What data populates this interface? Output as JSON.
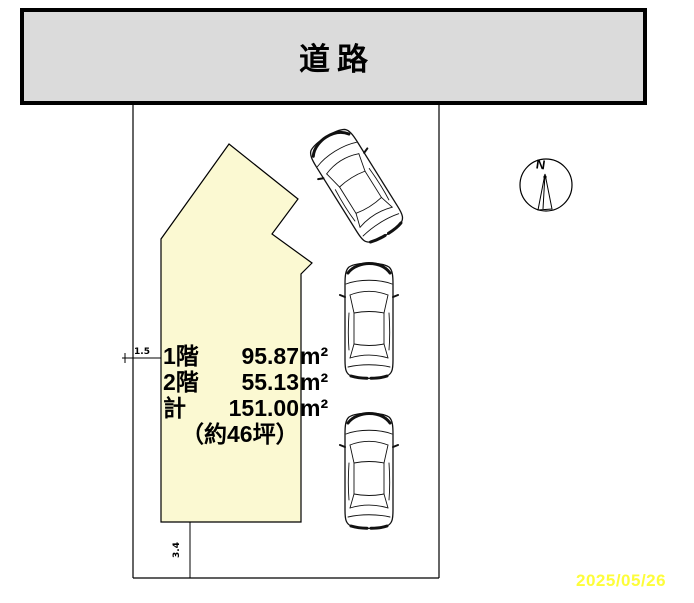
{
  "road": {
    "label": "道路"
  },
  "lot": {
    "dimension_labels": {
      "left_offset": "1.5",
      "bottom_offset": "3.4"
    }
  },
  "building": {
    "floor_rows": [
      {
        "label": "1階",
        "value": "95.87",
        "unit": "m²"
      },
      {
        "label": "2階",
        "value": "55.13",
        "unit": "m²"
      },
      {
        "label": "計",
        "value": "151.00",
        "unit": "m²"
      }
    ],
    "tsubo_note": "（約46坪）"
  },
  "compass": {
    "north_label": "N"
  },
  "cars": {
    "count": 3
  },
  "date_stamp": "2025/05/26",
  "colors": {
    "road_fill": "#dbdbdb",
    "building_fill": "#fbf9d2",
    "line": "#000000",
    "date_color": "#fdfd3a"
  }
}
